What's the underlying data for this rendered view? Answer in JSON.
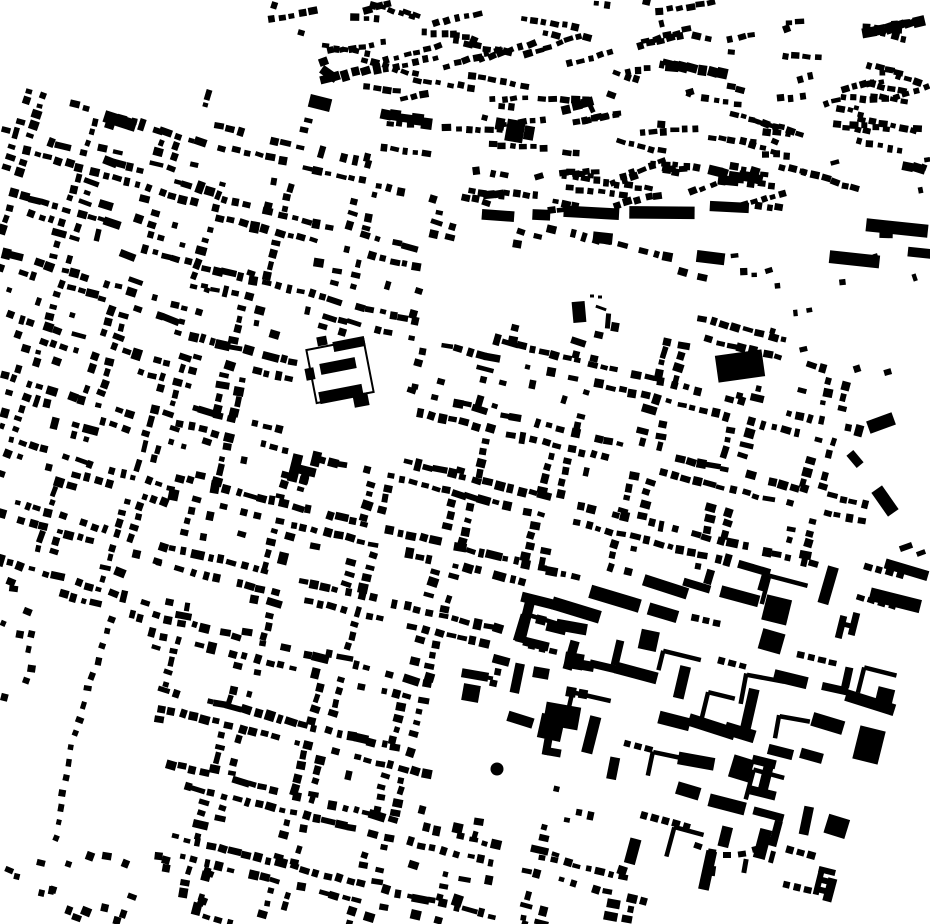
{
  "map": {
    "width": 930,
    "height": 924,
    "colors": {
      "background": "#ffffff",
      "building": "#000000"
    },
    "districts": [
      {
        "name": "left-strip",
        "type": "blockgrid",
        "x": -24,
        "y": 74,
        "rotation": 17,
        "cols": 5,
        "rows": 9,
        "block_w": 56,
        "block_h": 44,
        "street": 15,
        "spacing": 11,
        "dot": 6.4,
        "density": 0.75,
        "seed": 11,
        "clip": [
          [
            0,
            82
          ],
          [
            228,
            146
          ],
          [
            196,
            384
          ],
          [
            148,
            628
          ],
          [
            0,
            570
          ]
        ]
      },
      {
        "name": "central-grid",
        "type": "blockgrid",
        "x": 150,
        "y": 56,
        "rotation": 14,
        "cols": 11,
        "rows": 13,
        "block_w": 66,
        "block_h": 52,
        "street": 18,
        "spacing": 11.5,
        "dot": 6.6,
        "density": 0.78,
        "seed": 23,
        "clip": [
          [
            196,
            90
          ],
          [
            330,
            126
          ],
          [
            470,
            220
          ],
          [
            645,
            233
          ],
          [
            862,
            398
          ],
          [
            868,
            560
          ],
          [
            505,
            585
          ],
          [
            505,
            700
          ],
          [
            540,
            762
          ],
          [
            594,
            812
          ],
          [
            646,
            905
          ],
          [
            642,
            924
          ],
          [
            185,
            924
          ],
          [
            146,
            622
          ],
          [
            222,
            150
          ]
        ],
        "holes": [
          [
            [
              420,
              242
            ],
            [
              648,
              252
            ],
            [
              702,
              284
            ],
            [
              700,
              338
            ],
            [
              540,
              320
            ],
            [
              424,
              348
            ]
          ],
          [
            [
              298,
              330
            ],
            [
              410,
              336
            ],
            [
              406,
              464
            ],
            [
              294,
              458
            ]
          ],
          [
            [
              426,
              684
            ],
            [
              548,
              692
            ],
            [
              545,
              818
            ],
            [
              430,
              814
            ]
          ]
        ]
      },
      {
        "name": "southeast-blocks",
        "type": "bigblocks",
        "x": 505,
        "y": 440,
        "rotation": 14,
        "stepx": 38,
        "stepy": 33,
        "seed": 37,
        "clip": [
          [
            505,
            585
          ],
          [
            868,
            560
          ],
          [
            930,
            552
          ],
          [
            930,
            824
          ],
          [
            818,
            924
          ],
          [
            646,
            905
          ],
          [
            594,
            812
          ],
          [
            540,
            762
          ],
          [
            505,
            700
          ]
        ]
      },
      {
        "name": "north-organic",
        "type": "hamlets",
        "rotation_primary": 10,
        "rotation_secondary": -12,
        "count": 112,
        "singles": 30,
        "seed": 51,
        "clip": [
          [
            256,
            2
          ],
          [
            928,
            2
          ],
          [
            928,
            200
          ],
          [
            700,
            212
          ],
          [
            470,
            216
          ],
          [
            285,
            70
          ]
        ]
      },
      {
        "name": "north-band",
        "type": "band",
        "x1": 470,
        "y1": 214,
        "x2": 928,
        "y2": 204,
        "seed": 67,
        "lanes": [
          {
            "dy": 0,
            "density": 0.78,
            "from": 0
          },
          {
            "dy": 25,
            "density": 0.5,
            "from": 0.18
          },
          {
            "dy": 52,
            "density": 0.42,
            "from": 0.38
          }
        ]
      },
      {
        "name": "ne-pocket-scatter",
        "type": "singles",
        "count": 13,
        "size": [
          4,
          8
        ],
        "rotation": -10,
        "seed": 83,
        "clip": [
          [
            656,
            244
          ],
          [
            920,
            252
          ],
          [
            920,
            392
          ],
          [
            736,
            334
          ]
        ]
      },
      {
        "name": "bottom-left-scatter",
        "type": "singles",
        "count": 24,
        "size": [
          5,
          10
        ],
        "rotation": 15,
        "seed": 71,
        "clip": [
          [
            8,
            848
          ],
          [
            215,
            856
          ],
          [
            215,
            924
          ],
          [
            8,
            924
          ]
        ]
      },
      {
        "name": "west-edge-scatter",
        "type": "singles",
        "count": 10,
        "size": [
          5,
          9
        ],
        "rotation": 15,
        "seed": 73,
        "clip": [
          [
            0,
            572
          ],
          [
            60,
            590
          ],
          [
            40,
            710
          ],
          [
            0,
            700
          ]
        ]
      },
      {
        "name": "curve-street",
        "type": "dotline",
        "pts": [
          [
            113,
            618
          ],
          [
            84,
            700
          ],
          [
            66,
            770
          ],
          [
            57,
            838
          ]
        ],
        "n": 16,
        "dot": [
          5,
          8
        ],
        "seed": 79
      }
    ],
    "landmarks": [
      {
        "name": "nw-long-bar",
        "parts": [
          {
            "t": "rect",
            "cx": 120,
            "cy": 121,
            "w": 33,
            "h": 12,
            "rot": 18
          },
          {
            "t": "rect",
            "cx": 158,
            "cy": 131,
            "w": 10,
            "h": 6,
            "rot": 18
          }
        ]
      },
      {
        "name": "nw-bar-2",
        "parts": [
          {
            "t": "rect",
            "cx": 320,
            "cy": 103,
            "w": 22,
            "h": 13,
            "rot": 14
          }
        ]
      },
      {
        "name": "nw-bar-3",
        "parts": [
          {
            "t": "rect",
            "cx": 329,
            "cy": 74,
            "w": 18,
            "h": 9,
            "rot": 35
          }
        ]
      },
      {
        "name": "manor-estate",
        "parts": [
          {
            "t": "outline",
            "cx": 340,
            "cy": 371,
            "w": 58,
            "h": 54,
            "rot": -11
          },
          {
            "t": "rect",
            "cx": 349,
            "cy": 344,
            "w": 32,
            "h": 10,
            "rot": -11
          },
          {
            "t": "rect",
            "cx": 338,
            "cy": 366,
            "w": 36,
            "h": 11,
            "rot": -11
          },
          {
            "t": "rect",
            "cx": 341,
            "cy": 394,
            "w": 44,
            "h": 12,
            "rot": -11
          },
          {
            "t": "rect",
            "cx": 361,
            "cy": 400,
            "w": 15,
            "h": 13,
            "rot": -11
          },
          {
            "t": "rect",
            "cx": 310,
            "cy": 374,
            "w": 9,
            "h": 12,
            "rot": -11
          },
          {
            "t": "rect",
            "cx": 322,
            "cy": 341,
            "w": 10,
            "h": 9,
            "rot": -11
          }
        ]
      },
      {
        "name": "church-cross",
        "parts": [
          {
            "t": "rect",
            "cx": 295,
            "cy": 468,
            "w": 10,
            "h": 28,
            "rot": 14
          },
          {
            "t": "rect",
            "cx": 303,
            "cy": 470,
            "w": 26,
            "h": 9,
            "rot": 14
          },
          {
            "t": "rect",
            "cx": 316,
            "cy": 459,
            "w": 9,
            "h": 15,
            "rot": 14
          },
          {
            "t": "rect",
            "cx": 304,
            "cy": 480,
            "w": 9,
            "h": 7,
            "rot": 14
          }
        ]
      },
      {
        "name": "ne-big-rect",
        "parts": [
          {
            "t": "rect",
            "cx": 740,
            "cy": 366,
            "w": 47,
            "h": 27,
            "rot": -8
          }
        ]
      },
      {
        "name": "yard-blob",
        "parts": [
          {
            "t": "rect",
            "cx": 579,
            "cy": 312,
            "w": 13,
            "h": 21,
            "rot": -5
          },
          {
            "t": "rect",
            "cx": 592,
            "cy": 296,
            "w": 4,
            "h": 3,
            "rot": 0
          },
          {
            "t": "rect",
            "cx": 600,
            "cy": 297,
            "w": 4,
            "h": 3,
            "rot": 0
          },
          {
            "t": "rect",
            "cx": 601,
            "cy": 308,
            "w": 11,
            "h": 3,
            "rot": 20
          },
          {
            "t": "rect",
            "cx": 608,
            "cy": 321,
            "w": 5,
            "h": 15,
            "rot": 5
          },
          {
            "t": "rect",
            "cx": 615,
            "cy": 327,
            "w": 8,
            "h": 9,
            "rot": 10
          }
        ]
      },
      {
        "name": "plaza-circle",
        "parts": [
          {
            "t": "circle",
            "cx": 497,
            "cy": 769,
            "r": 6.5
          }
        ]
      },
      {
        "name": "plaza-bar",
        "parts": [
          {
            "t": "rect",
            "cx": 475,
            "cy": 675,
            "w": 27,
            "h": 9,
            "rot": 10
          },
          {
            "t": "rect",
            "cx": 490,
            "cy": 678,
            "w": 6,
            "h": 4,
            "rot": 10
          }
        ]
      },
      {
        "name": "plaza-square",
        "parts": [
          {
            "t": "rect",
            "cx": 471,
            "cy": 693,
            "w": 17,
            "h": 17,
            "rot": 10
          }
        ]
      },
      {
        "name": "plaza-big-rect",
        "parts": [
          {
            "t": "rect",
            "cx": 562,
            "cy": 716,
            "w": 35,
            "h": 23,
            "rot": 10
          }
        ]
      },
      {
        "name": "plaza-el",
        "parts": [
          {
            "t": "rect",
            "cx": 547,
            "cy": 747,
            "w": 8,
            "h": 16,
            "rot": 10
          },
          {
            "t": "rect",
            "cx": 552,
            "cy": 752,
            "w": 18,
            "h": 8,
            "rot": 10
          }
        ]
      },
      {
        "name": "plaza-squares",
        "parts": [
          {
            "t": "rect",
            "cx": 574,
            "cy": 661,
            "w": 19,
            "h": 16,
            "rot": 10
          },
          {
            "t": "rect",
            "cx": 588,
            "cy": 666,
            "w": 12,
            "h": 10,
            "rot": 10
          },
          {
            "t": "rect",
            "cx": 571,
            "cy": 692,
            "w": 10,
            "h": 10,
            "rot": 10
          },
          {
            "t": "rect",
            "cx": 583,
            "cy": 694,
            "w": 9,
            "h": 9,
            "rot": 10
          },
          {
            "t": "rect",
            "cx": 541,
            "cy": 673,
            "w": 16,
            "h": 11,
            "rot": 10
          }
        ]
      },
      {
        "name": "courtyard-manor",
        "parts": [
          {
            "t": "rect",
            "cx": 539,
            "cy": 601,
            "w": 36,
            "h": 10,
            "rot": 14
          },
          {
            "t": "rect",
            "cx": 525,
            "cy": 622,
            "w": 10,
            "h": 42,
            "rot": 14
          },
          {
            "t": "rect",
            "cx": 536,
            "cy": 644,
            "w": 26,
            "h": 9,
            "rot": 14
          },
          {
            "t": "rect",
            "cx": 556,
            "cy": 629,
            "w": 20,
            "h": 8,
            "rot": 14
          },
          {
            "t": "rect",
            "cx": 541,
            "cy": 620,
            "w": 10,
            "h": 9,
            "rot": 14
          }
        ]
      },
      {
        "name": "main-street-bar",
        "parts": [
          {
            "t": "rect",
            "cx": 576,
            "cy": 610,
            "w": 50,
            "h": 13,
            "rot": 17
          }
        ]
      },
      {
        "name": "h-building",
        "parts": [
          {
            "t": "rect",
            "cx": 841,
            "cy": 627,
            "w": 7,
            "h": 23,
            "rot": 14
          },
          {
            "t": "rect",
            "cx": 854,
            "cy": 624,
            "w": 7,
            "h": 23,
            "rot": 14
          },
          {
            "t": "rect",
            "cx": 847,
            "cy": 625,
            "w": 9,
            "h": 5,
            "rot": 14
          }
        ]
      },
      {
        "name": "se-square-small",
        "parts": [
          {
            "t": "rect",
            "cx": 885,
            "cy": 696,
            "w": 17,
            "h": 16,
            "rot": 14
          }
        ]
      },
      {
        "name": "se-square-big",
        "parts": [
          {
            "t": "rect",
            "cx": 869,
            "cy": 745,
            "w": 26,
            "h": 34,
            "rot": 14
          }
        ]
      },
      {
        "name": "i-beam-building",
        "parts": [
          {
            "t": "rect",
            "cx": 764,
            "cy": 762,
            "w": 24,
            "h": 9,
            "rot": 14
          },
          {
            "t": "rect",
            "cx": 766,
            "cy": 777,
            "w": 10,
            "h": 26,
            "rot": 14
          },
          {
            "t": "rect",
            "cx": 763,
            "cy": 793,
            "w": 26,
            "h": 9,
            "rot": 14
          }
        ]
      },
      {
        "name": "e-building",
        "parts": [
          {
            "t": "rect",
            "cx": 827,
            "cy": 871,
            "w": 17,
            "h": 6,
            "rot": 14
          },
          {
            "t": "rect",
            "cx": 826,
            "cy": 881,
            "w": 17,
            "h": 6,
            "rot": 14
          },
          {
            "t": "rect",
            "cx": 825,
            "cy": 891,
            "w": 17,
            "h": 6,
            "rot": 14
          },
          {
            "t": "rect",
            "cx": 819,
            "cy": 881,
            "w": 6,
            "h": 28,
            "rot": 14
          }
        ]
      },
      {
        "name": "east-bar-1",
        "parts": [
          {
            "t": "rect",
            "cx": 881,
            "cy": 423,
            "w": 27,
            "h": 13,
            "rot": -20
          }
        ]
      },
      {
        "name": "east-bar-2",
        "parts": [
          {
            "t": "rect",
            "cx": 885,
            "cy": 501,
            "w": 13,
            "h": 29,
            "rot": -35
          }
        ]
      },
      {
        "name": "east-bar-3",
        "parts": [
          {
            "t": "rect",
            "cx": 855,
            "cy": 459,
            "w": 9,
            "h": 16,
            "rot": -40
          }
        ]
      },
      {
        "name": "east-dashes",
        "parts": [
          {
            "t": "rect",
            "cx": 906,
            "cy": 547,
            "w": 13,
            "h": 6,
            "rot": -20
          },
          {
            "t": "rect",
            "cx": 921,
            "cy": 553,
            "w": 9,
            "h": 5,
            "rot": -20
          }
        ]
      },
      {
        "name": "band-long-bar",
        "parts": [
          {
            "t": "rect",
            "cx": 897,
            "cy": 228,
            "w": 62,
            "h": 13,
            "rot": 6
          }
        ]
      },
      {
        "name": "top-blob-cluster",
        "parts": [
          {
            "t": "rect",
            "cx": 515,
            "cy": 131,
            "w": 18,
            "h": 22,
            "rot": 10
          },
          {
            "t": "rect",
            "cx": 529,
            "cy": 133,
            "w": 10,
            "h": 14,
            "rot": 10
          },
          {
            "t": "rect",
            "cx": 500,
            "cy": 124,
            "w": 9,
            "h": 12,
            "rot": 10
          }
        ]
      },
      {
        "name": "se-arc-row",
        "parts": [
          {
            "t": "rect",
            "cx": 698,
            "cy": 846,
            "w": 8,
            "h": 6,
            "rot": 20
          },
          {
            "t": "rect",
            "cx": 712,
            "cy": 852,
            "w": 8,
            "h": 6,
            "rot": 10
          },
          {
            "t": "rect",
            "cx": 727,
            "cy": 855,
            "w": 8,
            "h": 6,
            "rot": 0
          },
          {
            "t": "rect",
            "cx": 742,
            "cy": 854,
            "w": 8,
            "h": 6,
            "rot": -8
          },
          {
            "t": "rect",
            "cx": 756,
            "cy": 849,
            "w": 8,
            "h": 6,
            "rot": -15
          },
          {
            "t": "rect",
            "cx": 768,
            "cy": 841,
            "w": 7,
            "h": 6,
            "rot": -22
          },
          {
            "t": "rect",
            "cx": 745,
            "cy": 866,
            "w": 5,
            "h": 14,
            "rot": 10
          },
          {
            "t": "rect",
            "cx": 772,
            "cy": 857,
            "w": 5,
            "h": 12,
            "rot": 15
          },
          {
            "t": "rect",
            "cx": 713,
            "cy": 871,
            "w": 5,
            "h": 10,
            "rot": 8
          }
        ]
      }
    ]
  }
}
